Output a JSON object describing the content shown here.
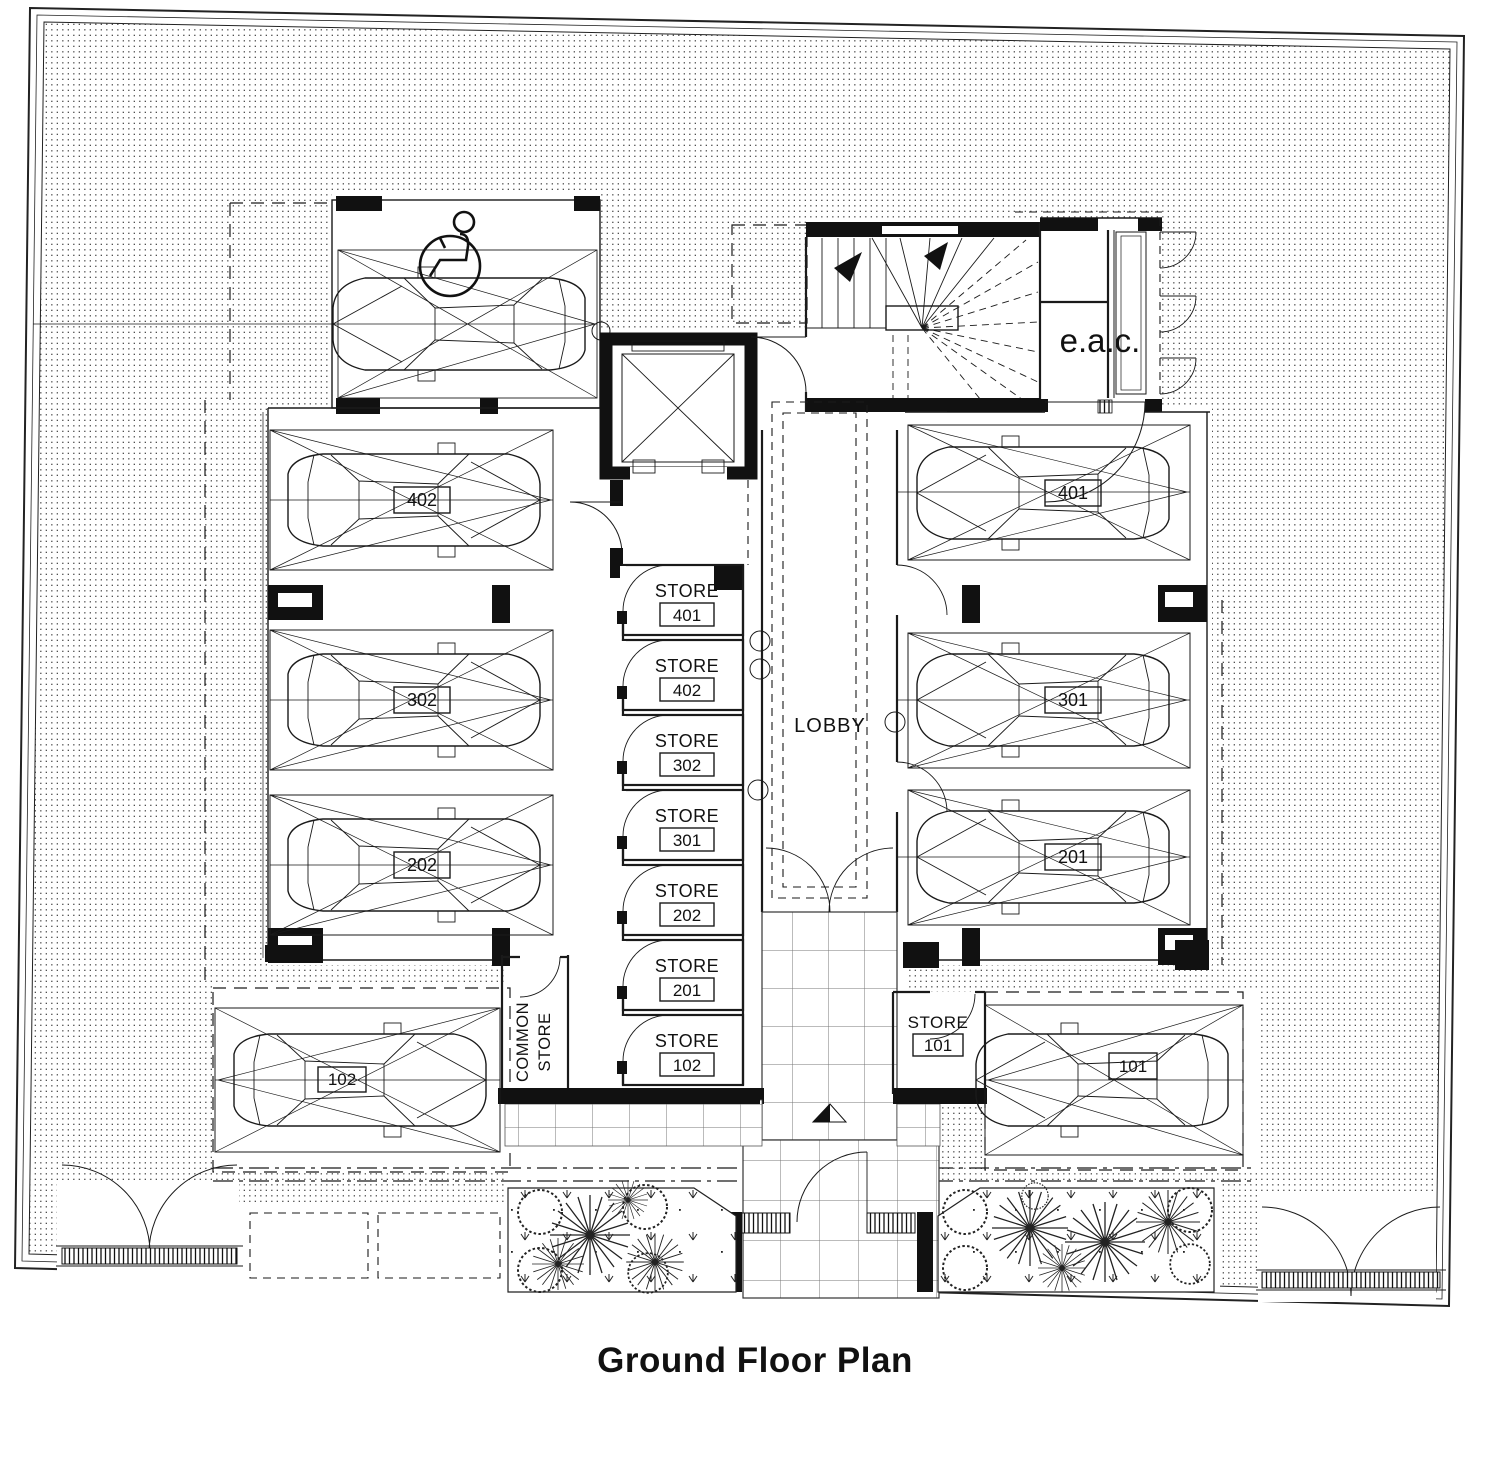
{
  "title": "Ground Floor Plan",
  "rooms": {
    "lobby": "LOBBY",
    "eac": "e.a.c.",
    "common_store_line1": "COMMON",
    "common_store_line2": "STORE"
  },
  "stores": [
    {
      "label": "STORE",
      "number": "401"
    },
    {
      "label": "STORE",
      "number": "402"
    },
    {
      "label": "STORE",
      "number": "302"
    },
    {
      "label": "STORE",
      "number": "301"
    },
    {
      "label": "STORE",
      "number": "202"
    },
    {
      "label": "STORE",
      "number": "201"
    },
    {
      "label": "STORE",
      "number": "102"
    },
    {
      "label": "STORE",
      "number": "101"
    }
  ],
  "parking": {
    "left": [
      "402",
      "302",
      "202"
    ],
    "right": [
      "401",
      "301",
      "201"
    ],
    "outside_left": "102",
    "outside_right": "101"
  },
  "colors": {
    "line": "#1a1a1a",
    "paper": "#ffffff"
  }
}
